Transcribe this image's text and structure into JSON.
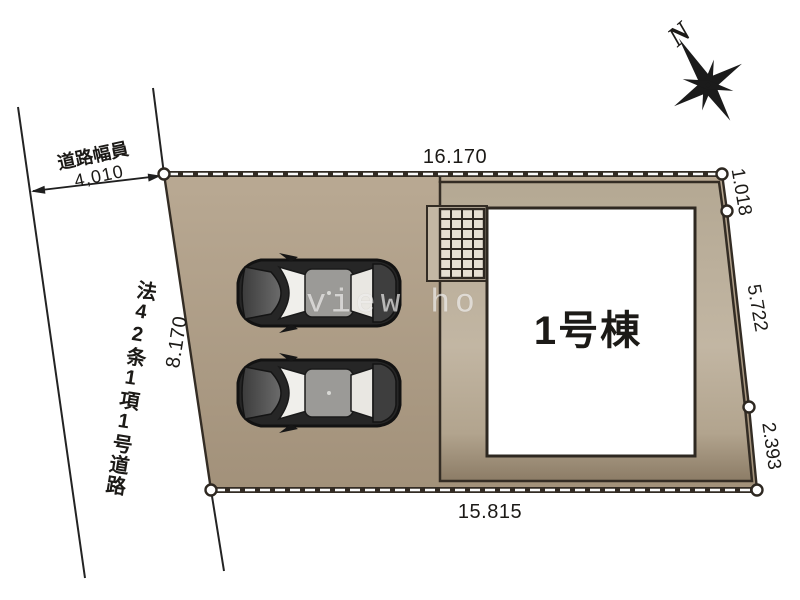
{
  "site_plan": {
    "building": {
      "label": "1号棟"
    },
    "dimensions": {
      "top": "16.170",
      "bottom": "15.815",
      "left": "8.170",
      "right_upper": "1.018",
      "right_middle": "5.722",
      "right_lower": "2.393"
    },
    "road": {
      "width_label": "道路幅員",
      "width_value": "4,010",
      "name": "法42条1項1号道路"
    },
    "compass": {
      "north_label": "N"
    },
    "watermark_text": "view ho",
    "colors": {
      "lot_fill": "#b3a38d",
      "lot_fill_dark": "#a2917a",
      "band_light": "#c2b6a3",
      "band_dark": "#8c7c66",
      "outline": "#332c24",
      "building_fill": "#ffffff",
      "line_color": "#232323",
      "grid_cell": "#e6dfd2",
      "porch_fill": "#c3b7a4",
      "dash_color": "#fafafa"
    }
  }
}
